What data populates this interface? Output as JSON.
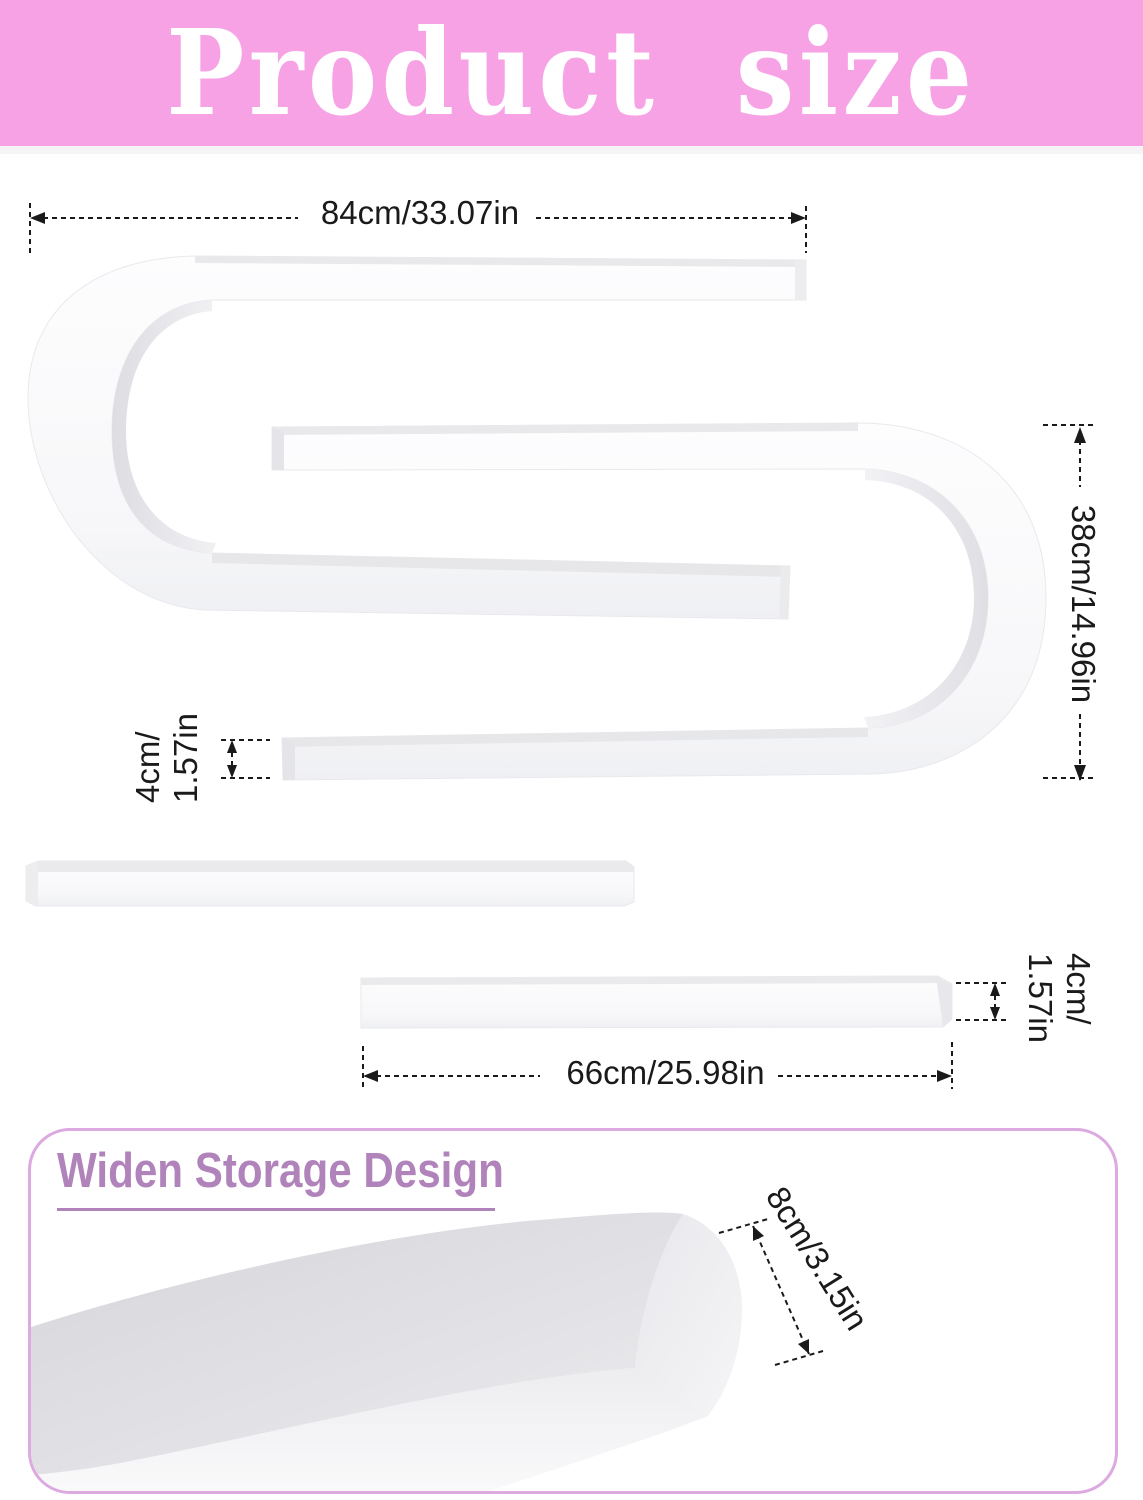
{
  "header": {
    "title": "Product size"
  },
  "diagram": {
    "top_width": "84cm/33.07in",
    "height": "38cm/14.96in",
    "left_thickness": [
      "4cm/",
      "1.57in"
    ],
    "right_thickness": [
      "4cm/",
      "1.57in"
    ],
    "bottom_width": "66cm/25.98in"
  },
  "storage_card": {
    "title": "Widen Storage Design",
    "depth": "8cm/3.15in"
  },
  "colors": {
    "header_bg": "#f8a2e6",
    "header_text": "#ffffff",
    "card_border": "#dca9e0",
    "card_accent": "#b183bb",
    "dimension_ink": "#1a1a1a",
    "product_white": "#fafafb"
  }
}
